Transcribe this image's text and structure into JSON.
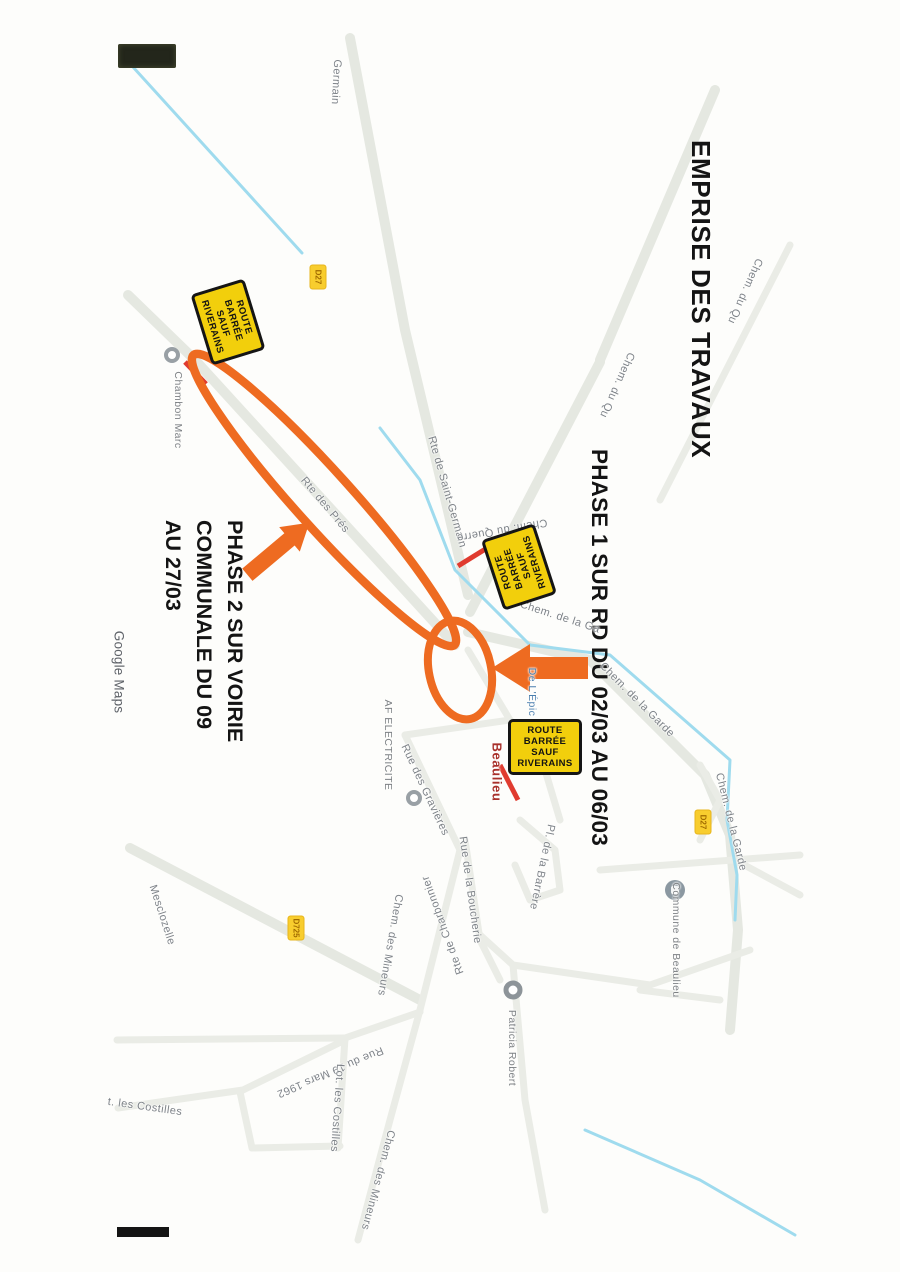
{
  "annotations": {
    "title": "EMPRISE DES TRAVAUX",
    "phase1": "PHASE 1 SUR RD DU 02/03 AU 06/03",
    "phase2": [
      "PHASE 2 SUR VOIRIE",
      "COMMUNALE DU 09",
      "AU 27/03"
    ]
  },
  "road_closed_sign": {
    "lines": [
      "ROUTE",
      "BARRÉE",
      "SAUF",
      "RIVERAINS"
    ],
    "instances": [
      {
        "x": 322,
        "y": 672,
        "rot": -17
      },
      {
        "x": 567,
        "y": 381,
        "rot": 162
      },
      {
        "x": 747,
        "y": 355,
        "rot": -90
      }
    ]
  },
  "map": {
    "credit": "Google Maps",
    "labels": [
      {
        "text": "Germain",
        "x": 82,
        "y": 564,
        "r": 3,
        "s": "street"
      },
      {
        "text": "Chem. du Qu",
        "x": 291,
        "y": 155,
        "r": 24,
        "s": "street"
      },
      {
        "text": "Chem. du Qu",
        "x": 385,
        "y": 283,
        "r": 24,
        "s": "street"
      },
      {
        "text": "Rte de Saint-Germain",
        "x": 492,
        "y": 453,
        "r": -16,
        "s": "street"
      },
      {
        "text": "Chem. du Querre",
        "x": 530,
        "y": 398,
        "r": 80,
        "s": "street"
      },
      {
        "text": "Rte des Prés",
        "x": 505,
        "y": 575,
        "r": -40,
        "s": "street"
      },
      {
        "text": "Chambon Marc",
        "x": 410,
        "y": 722,
        "r": 0,
        "s": "poi"
      },
      {
        "text": "Chem. de la Ga",
        "x": 617,
        "y": 340,
        "r": -72,
        "s": "street"
      },
      {
        "text": "Chem. de la Garde",
        "x": 700,
        "y": 263,
        "r": -45,
        "s": "street"
      },
      {
        "text": "Chem. de la Garde",
        "x": 822,
        "y": 169,
        "r": -14,
        "s": "street"
      },
      {
        "text": "De L'Épic",
        "x": 692,
        "y": 368,
        "r": 0,
        "s": "business"
      },
      {
        "text": "Beaulieu",
        "x": 772,
        "y": 403,
        "r": 0,
        "s": "locality"
      },
      {
        "text": "AF ELECTRICITE",
        "x": 745,
        "y": 512,
        "r": 0,
        "s": "poi"
      },
      {
        "text": "Rue des Gravières",
        "x": 790,
        "y": 475,
        "r": -25,
        "s": "street"
      },
      {
        "text": "Rte de Charbonnier",
        "x": 925,
        "y": 457,
        "r": 160,
        "s": "street"
      },
      {
        "text": "Rue de la Boucherie",
        "x": 890,
        "y": 430,
        "r": -8,
        "s": "street"
      },
      {
        "text": "Pl. de la Barrère",
        "x": 867,
        "y": 358,
        "r": 12,
        "s": "street"
      },
      {
        "text": "Chem. des Mineurs",
        "x": 945,
        "y": 510,
        "r": 10,
        "s": "street"
      },
      {
        "text": "Chem. des Mineurs",
        "x": 1180,
        "y": 522,
        "r": 15,
        "s": "street"
      },
      {
        "text": "Rue du 19 Mars 1962",
        "x": 1072,
        "y": 570,
        "r": 67,
        "s": "street"
      },
      {
        "text": "Lot. les Costilles",
        "x": 1108,
        "y": 563,
        "r": 4,
        "s": "street"
      },
      {
        "text": "t. les Costilles",
        "x": 1107,
        "y": 755,
        "r": -82,
        "s": "street"
      },
      {
        "text": "Mesclozelle",
        "x": 915,
        "y": 738,
        "r": -18,
        "s": "street"
      },
      {
        "text": "Patricia Robert",
        "x": 1048,
        "y": 388,
        "r": 0,
        "s": "poi"
      },
      {
        "text": "Commune de Beaulieu",
        "x": 940,
        "y": 224,
        "r": 0,
        "s": "poi"
      },
      {
        "text": "Google Maps",
        "x": 672,
        "y": 781,
        "r": 0,
        "s": "credit"
      }
    ],
    "route_badges": [
      {
        "label": "D27",
        "x": 277,
        "y": 582
      },
      {
        "label": "D725",
        "x": 928,
        "y": 604
      },
      {
        "label": "D27",
        "x": 822,
        "y": 197
      }
    ],
    "markers": [
      {
        "x": 355,
        "y": 728,
        "kind": "ring"
      },
      {
        "x": 798,
        "y": 486,
        "kind": "ring"
      },
      {
        "x": 990,
        "y": 387,
        "kind": "ring-large"
      },
      {
        "x": 890,
        "y": 225,
        "kind": "building"
      }
    ]
  },
  "colors": {
    "annotation_orange": "#ee6b21",
    "closure_red": "#e03b2f",
    "sign_yellow": "#f2cf0c",
    "water_blue": "#9fdbee",
    "road_gray": "#e5e8e1"
  }
}
